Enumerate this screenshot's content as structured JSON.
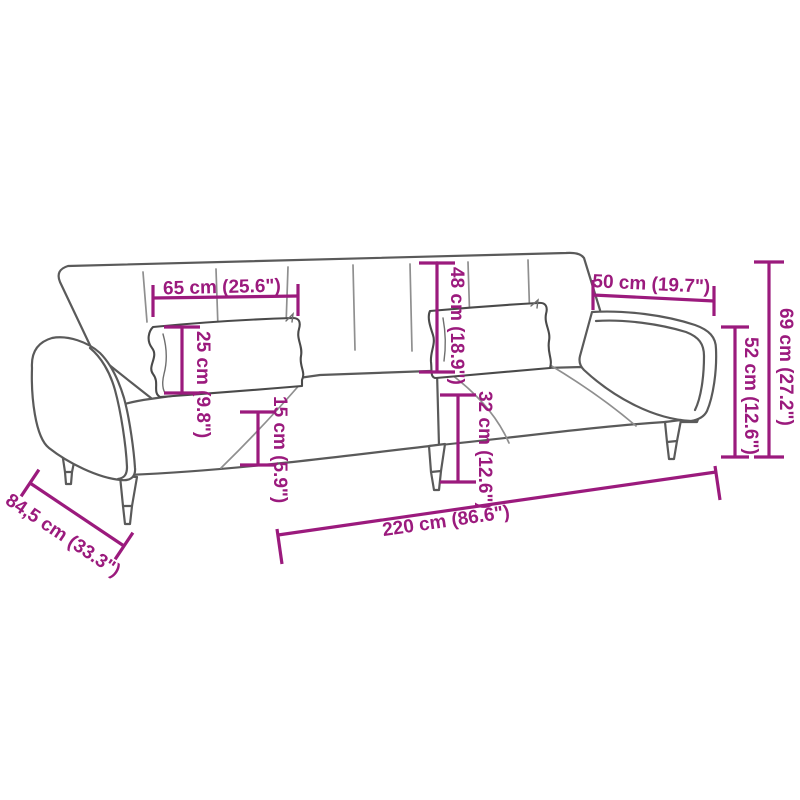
{
  "diagram": {
    "type": "product-dimension-diagram",
    "subject": "sofa-bed-line-drawing",
    "colors": {
      "accent": "#9B1A7D",
      "outline": "#5a5a5a",
      "background": "#ffffff"
    },
    "dimensions": {
      "d65": {
        "label": "65 cm (25.6\")"
      },
      "d25": {
        "label": "25 cm (9.8\")"
      },
      "d15": {
        "label": "15 cm (5.9\")"
      },
      "d48": {
        "label": "48 cm (18.9\")"
      },
      "d32": {
        "label": "32 cm (12.6\")"
      },
      "d50": {
        "label": "50 cm (19.7\")"
      },
      "d52": {
        "label": "52 cm (12.6\")"
      },
      "d69": {
        "label": "69 cm (27.2\")"
      },
      "d220": {
        "label": "220 cm (86.6\")"
      },
      "d845": {
        "label": "84,5 cm (33.3\")"
      }
    }
  }
}
